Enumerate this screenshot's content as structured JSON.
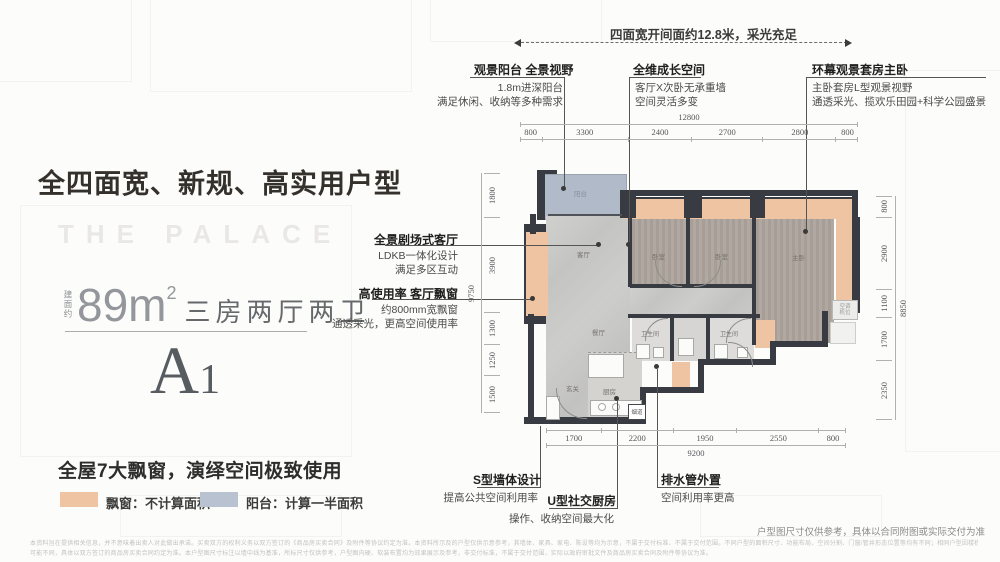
{
  "header": {
    "headline": "全四面宽、新规、高实用户型",
    "watermark": "THE PALACE",
    "top_note": "四面宽开间面约12.8米，采光充足"
  },
  "unit": {
    "area_prefix": "建面约",
    "area_value": "89m",
    "area_exp": "2",
    "layout_text": "三房两厅两卫",
    "unit_letter": "A",
    "unit_no": "1",
    "feature_title": "全屋7大飘窗，演绎空间极致使用"
  },
  "legend": {
    "bay_color": "#eec4a2",
    "bay_label": "飘窗：不计算面积",
    "balcony_color": "#b9c2d1",
    "balcony_label": "阳台：计算一半面积"
  },
  "callouts": {
    "balcony": {
      "title": "观景阳台 全景视野",
      "line1": "1.8m进深阳台",
      "line2": "满足休闲、收纳等多种需求"
    },
    "growth": {
      "title": "全维成长空间",
      "line1": "客厅X次卧无承重墙",
      "line2": "空间灵活多变"
    },
    "master": {
      "title": "环幕观景套房主卧",
      "line1": "主卧套房L型观景视野",
      "line2": "通透采光、揽欢乐田园+科学公园盛景"
    },
    "living": {
      "title": "全景剧场式客厅",
      "line1": "LDKB一体化设计",
      "line2": "满足多区互动"
    },
    "bay_window": {
      "title": "高使用率 客厅飘窗",
      "line1": "约800mm宽飘窗",
      "line2": "通透采光，更高空间使用率"
    },
    "s_wall": {
      "title": "S型墙体设计",
      "line1": "提高公共空间利用率"
    },
    "kitchen": {
      "title": "U型社交厨房",
      "line1": "操作、收纳空间最大化"
    },
    "drain": {
      "title": "排水管外置",
      "line1": "空间利用率更高"
    }
  },
  "dimensions": {
    "top": {
      "overall": "12800",
      "segments": [
        "800",
        "3300",
        "2400",
        "2700",
        "2800",
        "800"
      ]
    },
    "bottom": {
      "overall": "9200",
      "segments": [
        "1700",
        "2200",
        "1950",
        "2550",
        "800"
      ]
    },
    "left": {
      "overall": "9750",
      "segments": [
        "1800",
        "3900",
        "1300",
        "1250",
        "1500"
      ]
    },
    "right": {
      "overall": "8850",
      "segments": [
        "800",
        "2900",
        "1100",
        "1700",
        "2350"
      ]
    }
  },
  "rooms": {
    "balcony": "阳台",
    "living": "客厅",
    "dining": "餐厅",
    "entry": "玄关",
    "kitchen": "厨房",
    "bedroom": "卧室",
    "master": "主卧",
    "bath": "卫生间",
    "flue": "烟道",
    "ac": "空调机位"
  },
  "footer": {
    "plan_note": "户型图尺寸仅供参考，具体以合同附图或实际交付为准",
    "disclaimer_line1": "本资料旨在提供相关信息，并不意味着出卖人对此做出承诺。买卖双方的权利义务以双方签订的《商品房买卖合同》及附件等协议约定为准。本资料所示及的户型仅供示意参考，其墙体、家具、家电、陈设等均为示意，不属于交付标准、不属于交付范围。不同户型的面积尺寸、功能布局、空间分割、门窗/管井形态位置等均有不同；相同户型因楼栋、单元、楼层等差别，局部结构、面积、管线布置等也",
    "disclaimer_line2": "可能不同，具体以双方签订的商品房买卖合同约定为准。本户型图尺寸标注以墙中线为基准，所标尺寸仅供参考，户型图内硬、软装布置均为效果展示及参考，非交付标准，不属于交付范围，实际以政府审批文件及商品房买卖合同及附件等协议为准。"
  },
  "colors": {
    "bay_window": "#eec4a2",
    "balcony": "#b0bac8",
    "wall": "#383c42",
    "wood_floor": "#aba29b",
    "marble_floor": "#c9c9c7"
  }
}
